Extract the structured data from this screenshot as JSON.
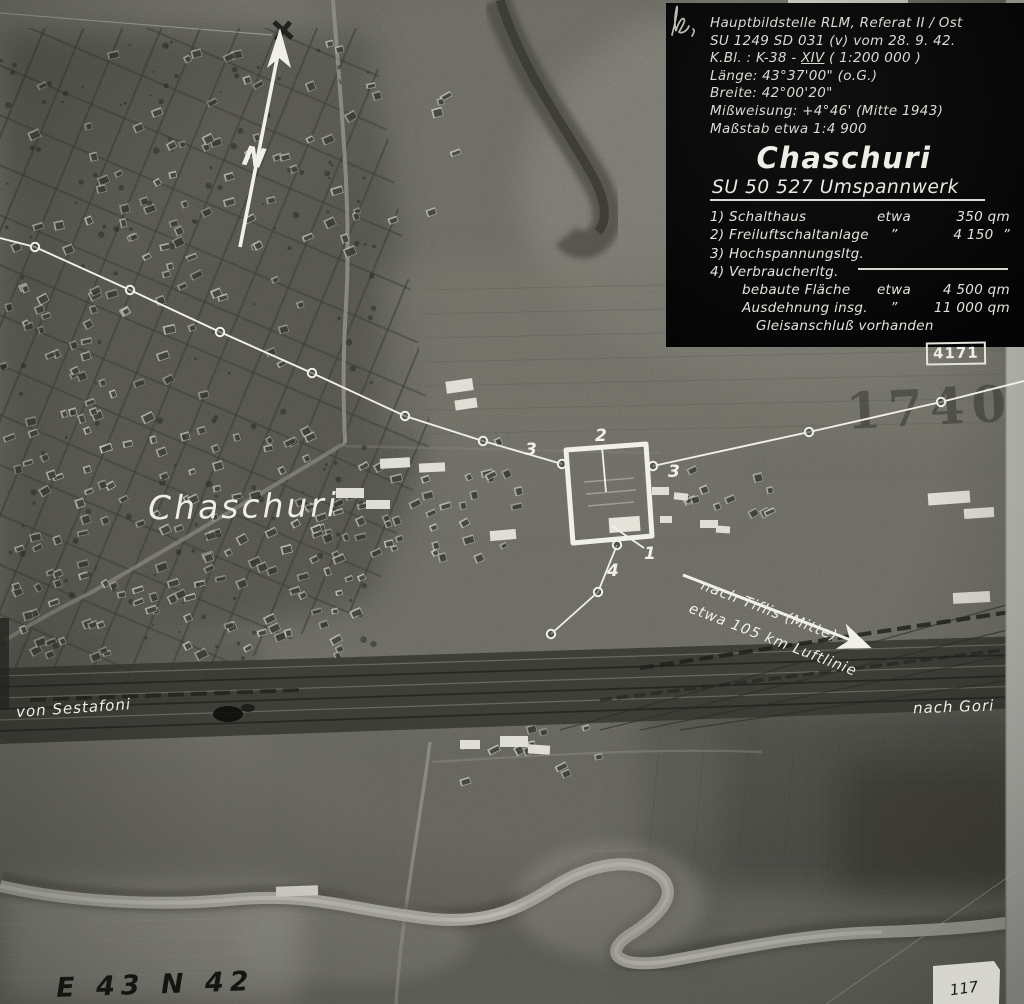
{
  "photo": {
    "north_label": "N",
    "town_label": "Chaschuri",
    "route_left": "von Sestafoni",
    "route_right": "nach Gori",
    "tiflis_line1": "nach Tiflis (Mitte)",
    "tiflis_line2": "etwa 105 km Luftlinie",
    "stamp_number": "1740",
    "corner_code": "E 43 N 42",
    "patch_number": "117",
    "markers": {
      "schalthaus": "1",
      "freiluftschaltanlage": "2",
      "hochspannungsltg_left": "3",
      "hochspannungsltg_right": "3",
      "verbraucherltg": "4"
    }
  },
  "info_panel": {
    "header_lines": [
      "Hauptbildstelle RLM, Referat II / Ost",
      "SU 1249 SD 031 (v) vom 28. 9. 42."
    ],
    "kbl": {
      "prefix": "K.Bl. : K-38 - ",
      "roman": "XIV",
      "suffix": "  ( 1:200 000 )"
    },
    "header_lines2": [
      "Länge: 43°37'00\" (o.G.)",
      "Breite: 42°00'20\"",
      "Mißweisung: +4°46' (Mitte 1943)",
      "Maßstab etwa 1:4 900"
    ],
    "title": "Chaschuri",
    "subtitle": "SU 50 527 Umspannwerk",
    "items": [
      {
        "label": "1) Schalthaus",
        "approx": "etwa",
        "value": "350 qm"
      },
      {
        "label": "2) Freiluftschaltanlage",
        "approx": "”",
        "value": "4 150  ”"
      },
      {
        "label": "3) Hochspannungsltg.",
        "approx": "",
        "value": ""
      },
      {
        "label": "4) Verbraucherltg.",
        "approx": "",
        "value": ""
      }
    ],
    "summary": [
      {
        "label": "bebaute Fläche",
        "approx": "etwa",
        "value": "4 500 qm"
      },
      {
        "label": "Ausdehnung insg.",
        "approx": "”",
        "value": "11 000 qm"
      }
    ],
    "note": "Gleisanschluß vorhanden",
    "ref_number": "4171"
  }
}
